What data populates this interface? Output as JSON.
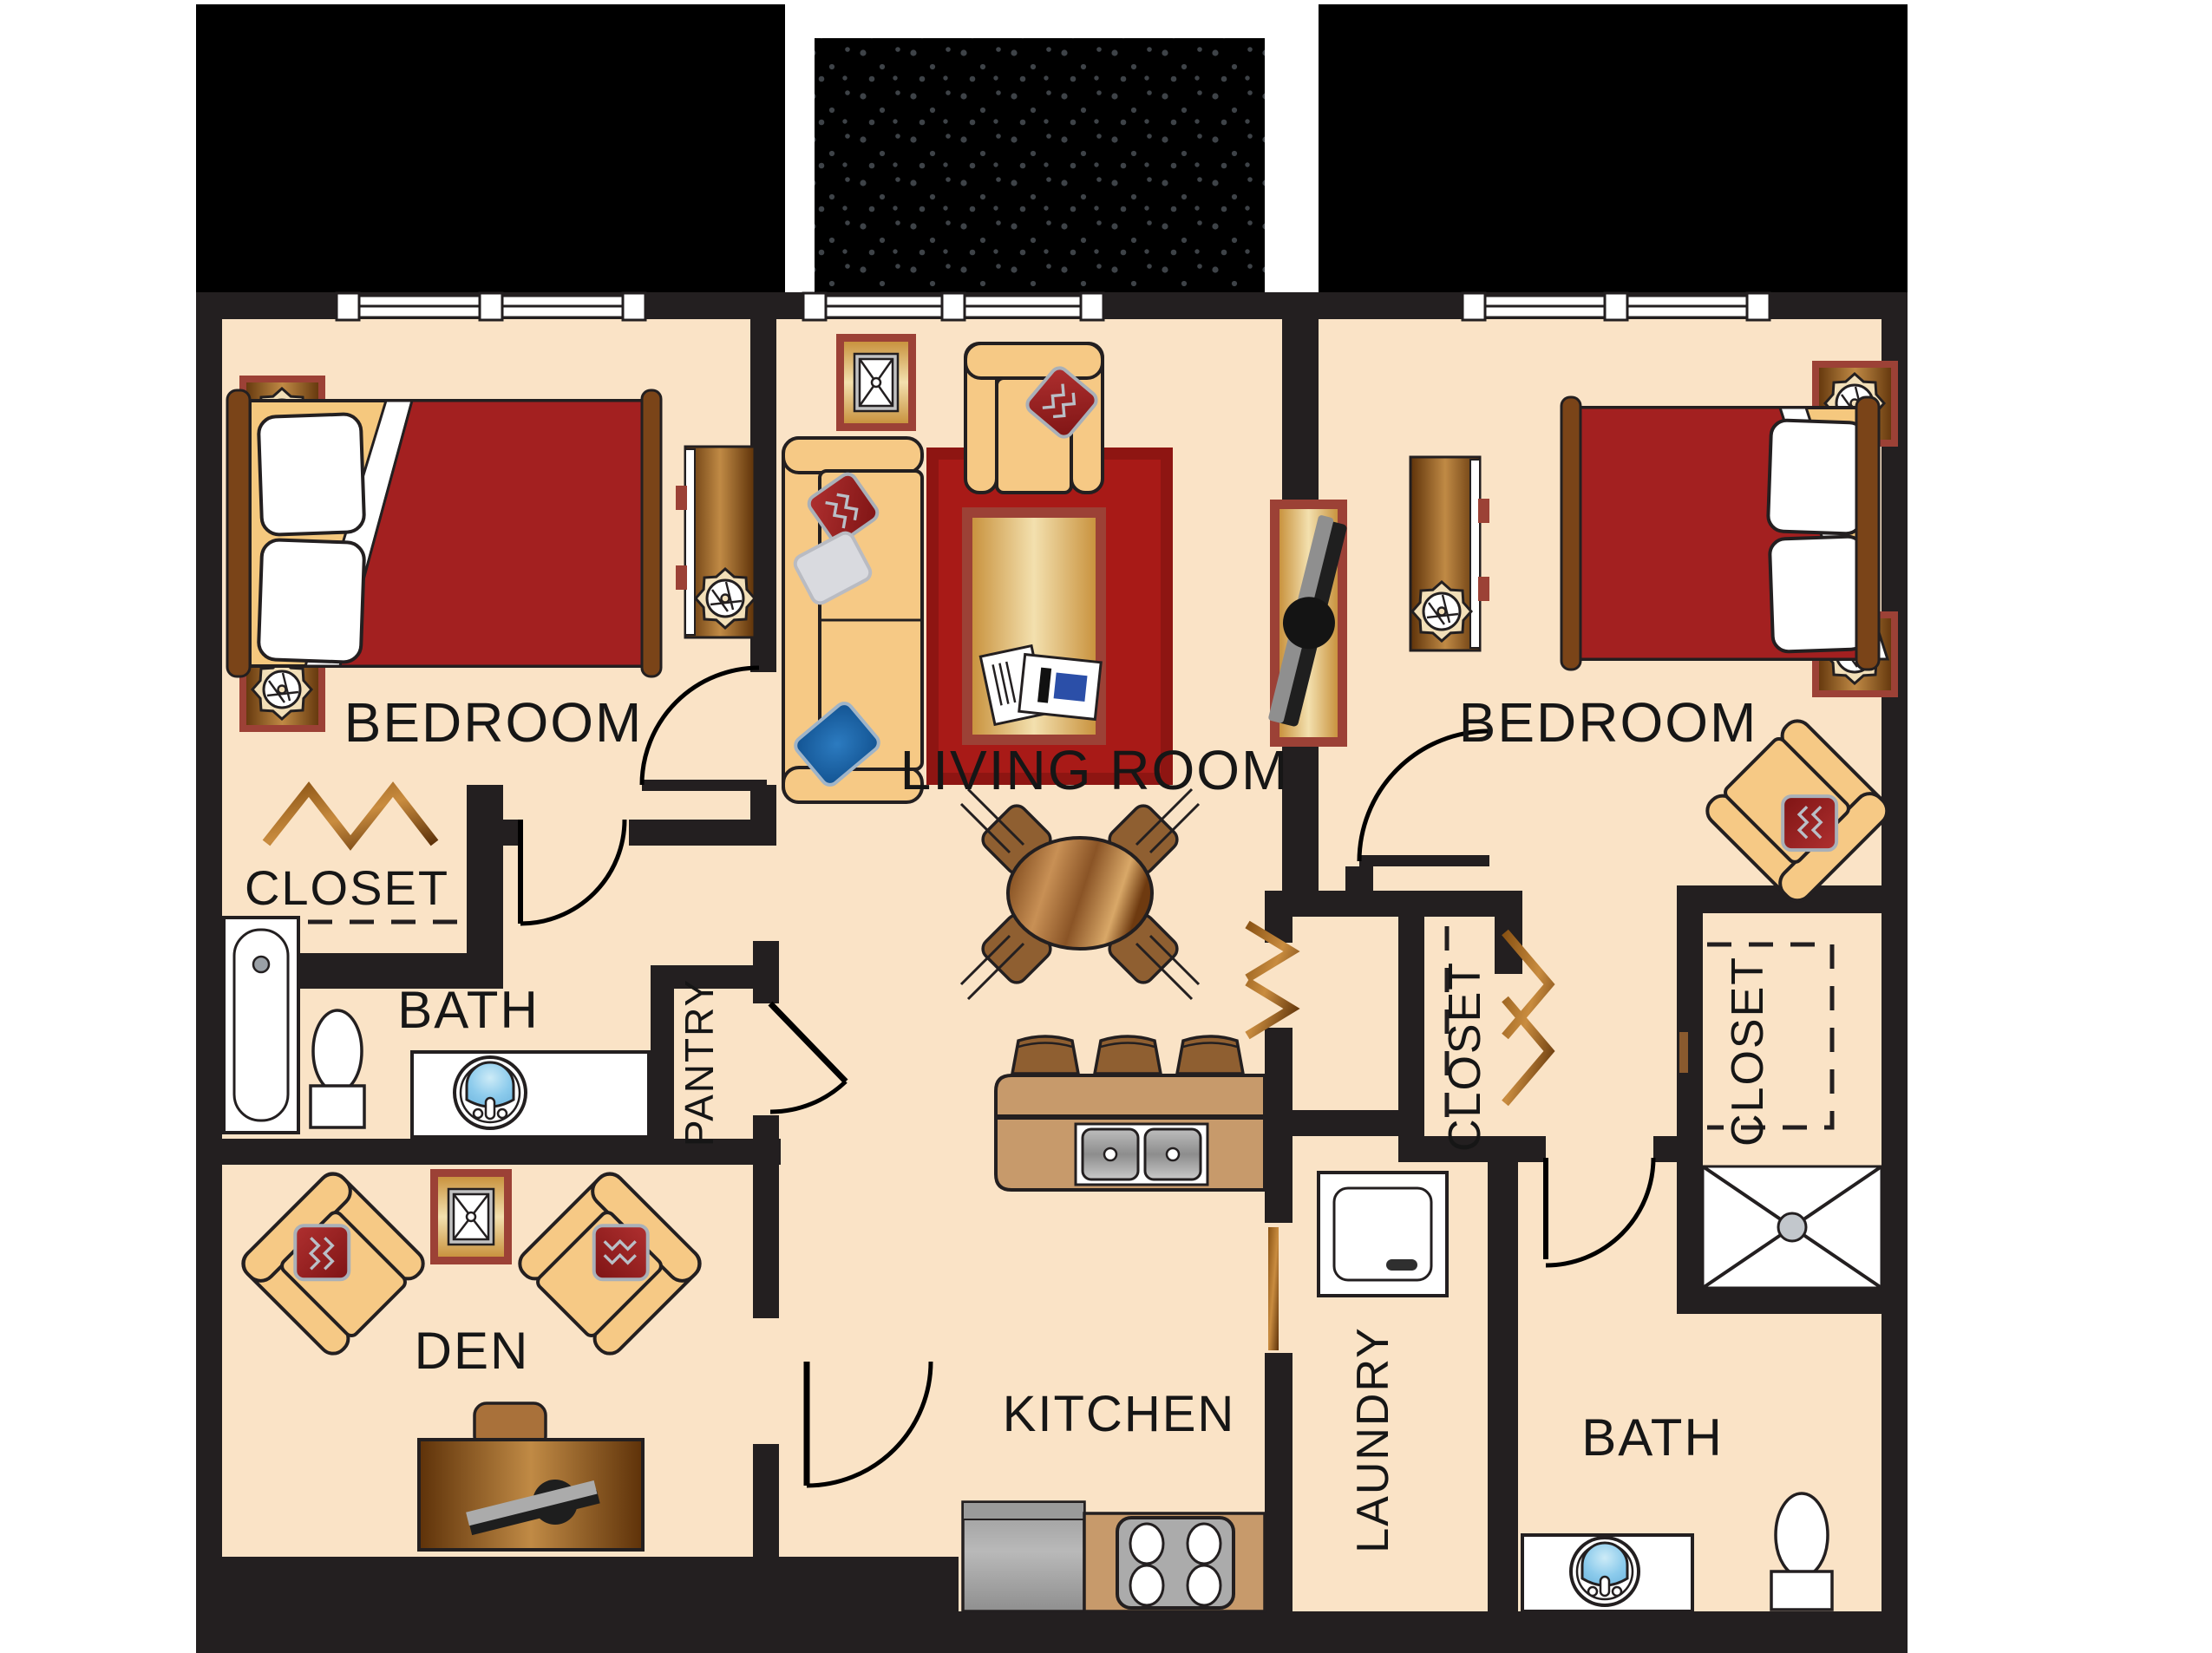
{
  "plan": {
    "type": "residential-floor-plan",
    "rooms": {
      "bedroom_left": {
        "label": "BEDROOM"
      },
      "living_room": {
        "label": "LIVING ROOM"
      },
      "bedroom_right": {
        "label": "BEDROOM"
      },
      "closet_left": {
        "label": "CLOSET"
      },
      "bath_left": {
        "label": "BATH"
      },
      "pantry": {
        "label": "PANTRY"
      },
      "den": {
        "label": "DEN"
      },
      "kitchen": {
        "label": "KITCHEN"
      },
      "laundry": {
        "label": "LAUNDRY"
      },
      "closet_middle": {
        "label": "CLOSET"
      },
      "closet_right": {
        "label": "CLOSET"
      },
      "bath_right": {
        "label": "BATH"
      }
    },
    "colors": {
      "floor": "#FAE3C6",
      "wall": "#231F20",
      "terrace": "#000000",
      "terrace_speck": "#3E4348",
      "upholstery_tan": "#F6C985",
      "wood_light": "#C08A45",
      "wood_dark": "#6E3A10",
      "frame_red": "#9C4136",
      "rug_red": "#A81A17",
      "blanket_red": "#A32020",
      "counter_tan": "#C79A6B",
      "appliance_gray": "#ABABAB",
      "sink_blue": "#8CCBEC",
      "pillow_blue": "#1F6FB5",
      "label_text": "#161616"
    }
  }
}
